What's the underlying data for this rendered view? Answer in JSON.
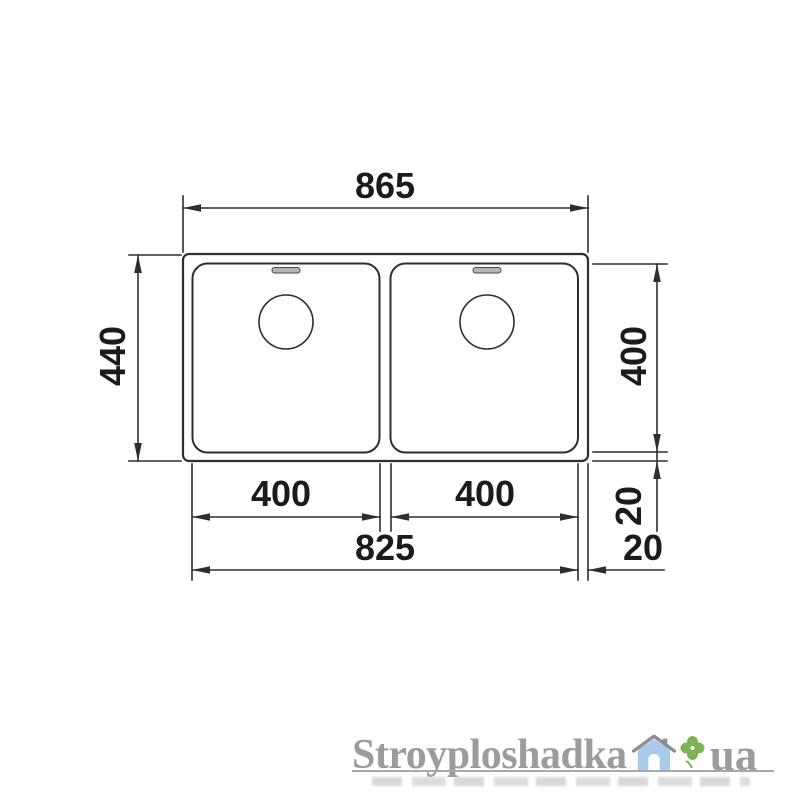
{
  "diagram": {
    "title": "double-bowl-sink-dimension-drawing",
    "dimensions": {
      "overall_width": "865",
      "overall_depth": "440",
      "bowl_depth": "400",
      "bowl1_width": "400",
      "bowl2_width": "400",
      "bowls_outer_span": "825",
      "rim_bottom_gap": "20",
      "rim_right_gap": "20"
    },
    "line_color": "#2e2e2e",
    "text_color": "#1b1b1b"
  },
  "watermark": {
    "brand": "Stroyploshadka",
    "suffix": "ua",
    "text_color": "#9c9c9c",
    "house_color": "#a9cbe9",
    "roof_color": "#8f8f8f",
    "door_color": "#ffffff",
    "clover_color": "#7db356"
  }
}
